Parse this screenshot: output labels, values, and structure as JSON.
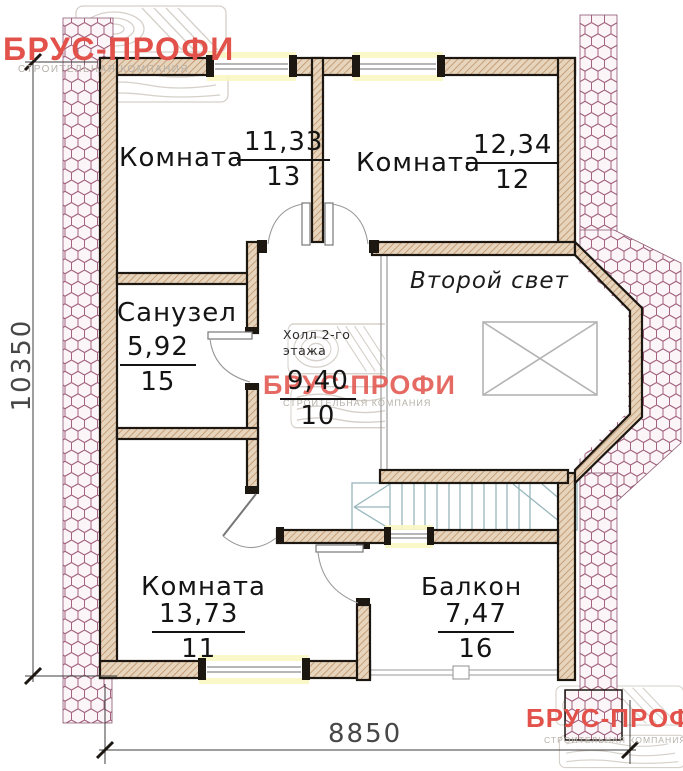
{
  "branding": {
    "name": "БРУС-ПРОФИ",
    "subtitle": "СТРОИТЕЛЬНАЯ КОМПАНИЯ"
  },
  "rooms": {
    "room_top_left": {
      "name": "Комната",
      "area": "11,33",
      "number": "13"
    },
    "room_top_right": {
      "name": "Комната",
      "area": "12,34",
      "number": "12"
    },
    "bathroom": {
      "name": "Санузел",
      "area": "5,92",
      "number": "15"
    },
    "hall": {
      "name": "Холл 2-го этажа",
      "area": "9,40",
      "number": "10"
    },
    "second_light": {
      "name": "Второй свет"
    },
    "room_bottom": {
      "name": "Комната",
      "area": "13,73",
      "number": "11"
    },
    "balcony": {
      "name": "Балкон",
      "area": "7,47",
      "number": "16"
    }
  },
  "dimensions": {
    "width_mm": "8850",
    "height_mm": "10350"
  },
  "colors": {
    "logo_red": "#e2514a",
    "hatch_pink": "#a4637f",
    "wall_fill": "#e6d4bc",
    "stairs_blue": "#97b7bd"
  }
}
